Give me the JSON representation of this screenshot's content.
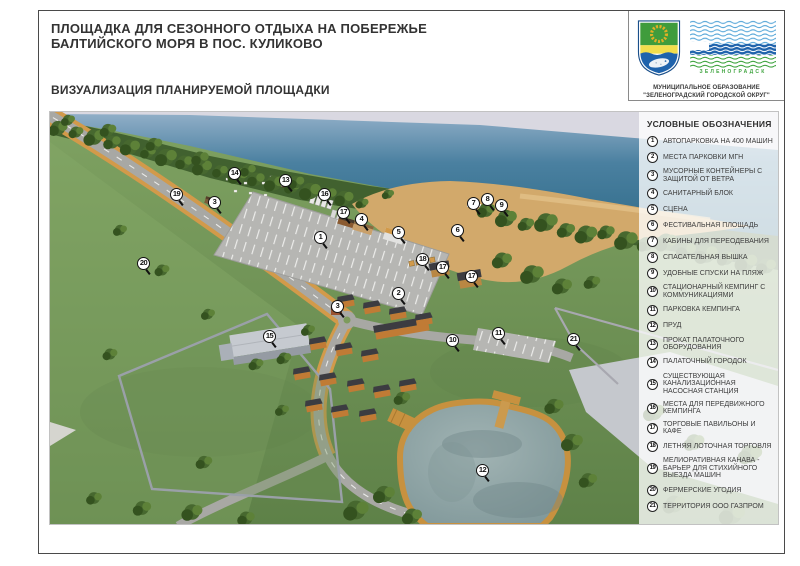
{
  "page": {
    "title_line1": "ПЛОЩАДКА ДЛЯ СЕЗОННОГО ОТДЫХА НА ПОБЕРЕЖЬЕ",
    "title_line2": "БАЛТИЙСКОГО МОРЯ В ПОС. КУЛИКОВО",
    "subtitle": "ВИЗУАЛИЗАЦИЯ ПЛАНИРУЕМОЙ ПЛОЩАДКИ"
  },
  "header_logos": {
    "municipality_line1": "МУНИЦИПАЛЬНОЕ ОБРАЗОВАНИЕ",
    "municipality_line2": "\"ЗЕЛЕНОГРАДСКИЙ ГОРОДСКОЙ ОКРУГ\"",
    "wave_logo_caption": "ЗЕЛЕНОГРАДСК",
    "icons": [
      "zelenogradsk-coat-of-arms-icon",
      "zelenogradsk-waves-logo-icon"
    ]
  },
  "legend": {
    "title": "УСЛОВНЫЕ ОБОЗНАЧЕНИЯ",
    "items": [
      {
        "n": "1",
        "label": "АВТОПАРКОВКА НА 400 МАШИН"
      },
      {
        "n": "2",
        "label": "МЕСТА ПАРКОВКИ МГН"
      },
      {
        "n": "3",
        "label": "МУСОРНЫЕ КОНТЕЙНЕРЫ С ЗАЩИТОЙ ОТ ВЕТРА"
      },
      {
        "n": "4",
        "label": "САНИТАРНЫЙ БЛОК"
      },
      {
        "n": "5",
        "label": "СЦЕНА"
      },
      {
        "n": "6",
        "label": "ФЕСТИВАЛЬНАЯ ПЛОЩАДЬ"
      },
      {
        "n": "7",
        "label": "КАБИНЫ ДЛЯ ПЕРЕОДЕВАНИЯ"
      },
      {
        "n": "8",
        "label": "СПАСАТЕЛЬНАЯ ВЫШКА"
      },
      {
        "n": "9",
        "label": "УДОБНЫЕ СПУСКИ НА ПЛЯЖ"
      },
      {
        "n": "10",
        "label": "СТАЦИОНАРНЫЙ КЕМПИНГ С КОММУНИКАЦИЯМИ"
      },
      {
        "n": "11",
        "label": "ПАРКОВКА КЕМПИНГА"
      },
      {
        "n": "12",
        "label": "ПРУД"
      },
      {
        "n": "13",
        "label": "ПРОКАТ ПАЛАТОЧНОГО ОБОРУДОВАНИЯ"
      },
      {
        "n": "14",
        "label": "ПАЛАТОЧНЫЙ ГОРОДОК"
      },
      {
        "n": "15",
        "label": "СУЩЕСТВУЮЩАЯ КАНАЛИЗАЦИОННАЯ НАСОСНАЯ СТАНЦИЯ"
      },
      {
        "n": "16",
        "label": "МЕСТА ДЛЯ ПЕРЕДВИЖНОГО КЕМПИНГА"
      },
      {
        "n": "17",
        "label": "ТОРГОВЫЕ ПАВИЛЬОНЫ И КАФЕ"
      },
      {
        "n": "18",
        "label": "ЛЕТНЯЯ ЛОТОЧНАЯ ТОРГОВЛЯ"
      },
      {
        "n": "19",
        "label": "МЕЛИОРАТИВНАЯ КАНАВА - БАРЬЕР ДЛЯ СТИХИЙНОГО ВЫЕЗДА МАШИН"
      },
      {
        "n": "20",
        "label": "ФЕРМЕРСКИЕ УГОДИЯ"
      },
      {
        "n": "21",
        "label": "ТЕРРИТОРИЯ ООО ГАЗПРОМ"
      }
    ]
  },
  "map": {
    "markers": [
      {
        "n": "1",
        "x": 271,
        "y": 126
      },
      {
        "n": "2",
        "x": 349,
        "y": 182
      },
      {
        "n": "3",
        "x": 165,
        "y": 91
      },
      {
        "n": "3",
        "x": 288,
        "y": 195
      },
      {
        "n": "4",
        "x": 312,
        "y": 108
      },
      {
        "n": "5",
        "x": 349,
        "y": 121
      },
      {
        "n": "6",
        "x": 408,
        "y": 119
      },
      {
        "n": "7",
        "x": 424,
        "y": 92
      },
      {
        "n": "8",
        "x": 438,
        "y": 88
      },
      {
        "n": "9",
        "x": 452,
        "y": 94
      },
      {
        "n": "10",
        "x": 403,
        "y": 229
      },
      {
        "n": "11",
        "x": 449,
        "y": 222
      },
      {
        "n": "12",
        "x": 433,
        "y": 359
      },
      {
        "n": "13",
        "x": 236,
        "y": 69
      },
      {
        "n": "14",
        "x": 185,
        "y": 62
      },
      {
        "n": "15",
        "x": 220,
        "y": 225
      },
      {
        "n": "16",
        "x": 275,
        "y": 83
      },
      {
        "n": "17",
        "x": 294,
        "y": 101
      },
      {
        "n": "17",
        "x": 393,
        "y": 156
      },
      {
        "n": "17",
        "x": 422,
        "y": 165
      },
      {
        "n": "18",
        "x": 373,
        "y": 148
      },
      {
        "n": "19",
        "x": 127,
        "y": 83
      },
      {
        "n": "20",
        "x": 94,
        "y": 152
      },
      {
        "n": "21",
        "x": 524,
        "y": 228
      }
    ]
  },
  "colors": {
    "sea": "#2e6a87",
    "sand": "#d2a96b",
    "grass": "#6f9154",
    "road": "#a8a8a4",
    "ditch_orange": "#d29a4a",
    "legend_bg": "rgba(255,255,255,0.78)",
    "logo_green": "#3fa43f",
    "logo_blue": "#1f63ac"
  }
}
